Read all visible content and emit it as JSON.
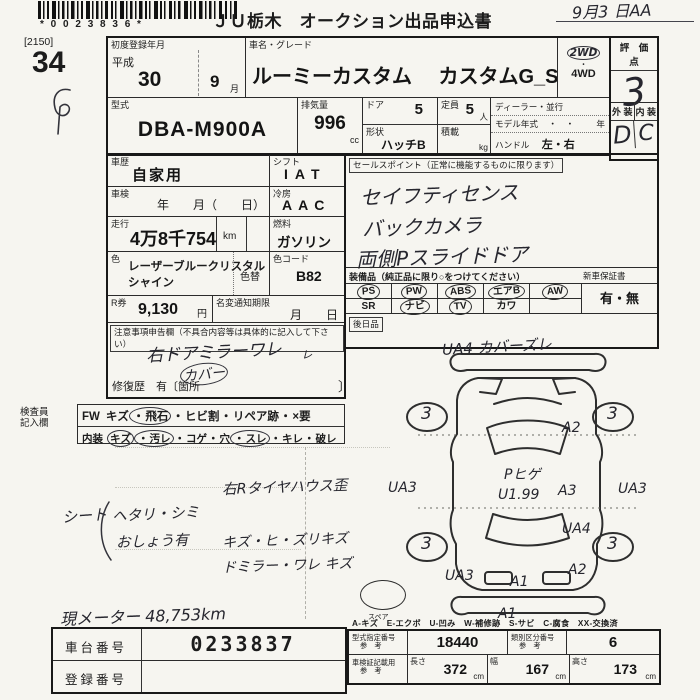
{
  "page": {
    "barcode_digits": "* 0 0 2 3 8 3 6 *",
    "title": "ＪＵ栃木　オークション出品申込書",
    "date_hand": "9月3 日AA",
    "sheet_code": "[2150]",
    "lot_number": "34"
  },
  "top": {
    "reg_label": "初度登録年月",
    "era": "平成",
    "reg_year": "30",
    "reg_month": "9",
    "month_unit": "月",
    "name_label": "車名・グレード",
    "car_name": "ルーミーカスタム",
    "car_grade": "カスタムG_S",
    "wd2": "2WD",
    "wd_dot": "・",
    "wd4": "4WD",
    "score_label": "評　価　点",
    "score_value": "3",
    "ext_label": "外 装",
    "int_label": "内 装",
    "ext_value": "D",
    "int_value": "C",
    "model_label": "型式",
    "model_value": "DBA-M900A",
    "disp_label": "排気量",
    "disp_value": "996",
    "disp_unit": "cc",
    "door_label": "ドア",
    "door_value": "5",
    "shape_label": "形状",
    "shape_value": "ハッチB",
    "cap_label": "定員",
    "cap_value": "5",
    "cap_unit": "人",
    "load_label": "積載",
    "load_unit": "kg",
    "dealer_label": "ディーラー・並行",
    "modelyear_label": "モデル年式",
    "modelyear_dots": "・　・",
    "modelyear_unit": "年",
    "handle_label": "ハンドル",
    "handle_value": "左・右"
  },
  "mid": {
    "history_label": "車歴",
    "history_value": "自家用",
    "shift_label": "シフト",
    "shift_value": "IAT",
    "syaken_label": "車検",
    "syaken_value": "年　　月（　　日）",
    "ac_label": "冷房",
    "ac_value": "AAC",
    "run_label": "走行",
    "run_value": "4万8千754",
    "run_unit": "km",
    "fuel_label": "燃料",
    "fuel_value": "ガソリン",
    "color_label": "色",
    "color_value1": "レーザーブルークリスタル",
    "color_value2": "シャイン",
    "colorchg_label": "色替",
    "colorcode_label": "色コード",
    "colorcode_value": "B82",
    "rken_label": "R券",
    "rken_value": "9,130",
    "rken_unit": "円",
    "meihen_label": "名変通知期限",
    "meihen_value": "月　　日",
    "notes_label": "注意事項申告欄（不具合内容等は具体的に記入して下さい）",
    "notes_line1": "右ドアミラーワレ",
    "notes_line2": "カバー",
    "notes_check": "ㇾ",
    "repair_text": "修復歴　有〔箇所",
    "repair_close": "〕"
  },
  "sales": {
    "label": "セールスポイント（正常に機能するものに限ります）",
    "line1": "セイフティセンス",
    "line2": "バックカメラ",
    "line3": "両側Pスライドドア"
  },
  "equip": {
    "label": "装備品（純正品に限り○をつけてください）",
    "warranty_label": "新車保証書",
    "warranty_value": "有・無",
    "rows": [
      {
        "items": [
          {
            "label": "PS",
            "circled": true
          },
          {
            "label": "PW",
            "circled": true
          },
          {
            "label": "ABS",
            "circled": true
          },
          {
            "label": "エアB",
            "circled": true
          },
          {
            "label": "AW",
            "circled": true
          }
        ]
      },
      {
        "items": [
          {
            "label": "SR",
            "circled": false
          },
          {
            "label": "ナビ",
            "circled": true
          },
          {
            "label": "TV",
            "circled": true
          },
          {
            "label": "カワ",
            "circled": false
          },
          {
            "label": "",
            "circled": false
          }
        ]
      }
    ],
    "later_label": "後日品"
  },
  "inspector": {
    "label1": "検査員",
    "label2": "記入欄",
    "row1": {
      "head": "FW",
      "items": [
        {
          "label": "キズ",
          "circled": false
        },
        {
          "label": "飛石",
          "circled": true
        },
        {
          "label": "ヒビ割",
          "circled": false
        },
        {
          "label": "リペア跡",
          "circled": false
        },
        {
          "label": "×要",
          "circled": false
        }
      ]
    },
    "row2": {
      "head": "内装",
      "items": [
        {
          "label": "キズ",
          "circled": true
        },
        {
          "label": "汚レ",
          "circled": true
        },
        {
          "label": "コゲ",
          "circled": false
        },
        {
          "label": "穴",
          "circled": false
        },
        {
          "label": "スレ",
          "circled": true
        },
        {
          "label": "キレ",
          "circled": false
        },
        {
          "label": "破レ",
          "circled": false
        }
      ]
    }
  },
  "handnotes": {
    "seat1": "シート",
    "seat2": "ヘタリ・シミ",
    "seat3": "おしょう有",
    "note1": "右Rタイヤハウス歪",
    "note2": "キズ・ヒ・ズリキズ",
    "note3": "ドミラー・ワレ キズ",
    "meter": "現メーター 48,753km"
  },
  "diagram": {
    "top_note": "UA4 カバーズレ",
    "roof1": "Pヒゲ",
    "roof2": "U1.99",
    "wheel_fl": "3",
    "wheel_fr": "3",
    "wheel_rl": "3",
    "wheel_rr": "3",
    "a2_front": "A2",
    "ua3_left": "UA3",
    "a3_mid": "A3",
    "ua3_right": "UA3",
    "ua4_right": "UA4",
    "ua3_rear_left": "UA3",
    "a2_rear": "A2",
    "a1_rear": "A1",
    "a1_bumper": "A1",
    "spare_label": "スペア",
    "legend": "A-キズ　E-エクボ　U-凹み　W-補修跡　S-サビ　C-腐食　XX-交換済"
  },
  "bottom": {
    "chassis_label": "車台番号",
    "chassis_value": "0233837",
    "plate_label": "登録番号",
    "plate_value": "",
    "spec1_label1": "型式指定番号",
    "spec1_label2": "参　考",
    "spec1_value": "18440",
    "spec2_label1": "類別区分番号",
    "spec2_label2": "参　考",
    "spec2_value": "6",
    "size_label1": "車検証記載用",
    "size_label2": "参　考",
    "len_label": "長さ",
    "len_value": "372",
    "len_unit": "cm",
    "wid_label": "幅",
    "wid_value": "167",
    "wid_unit": "cm",
    "hgt_label": "高さ",
    "hgt_value": "173",
    "hgt_unit": "cm"
  }
}
